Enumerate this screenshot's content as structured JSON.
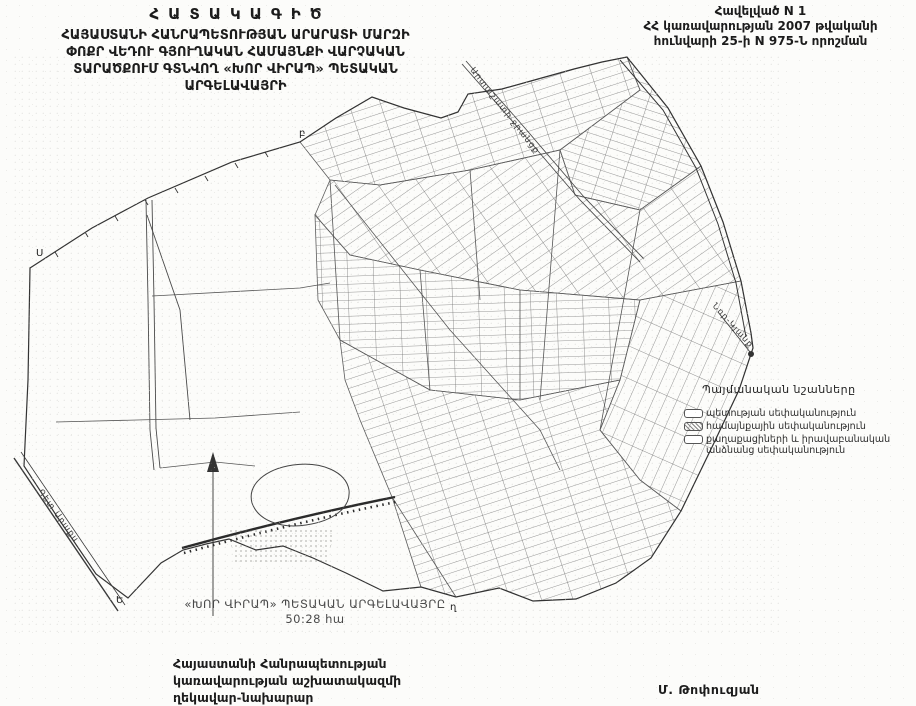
{
  "header": {
    "title": "ՀԱՏԱԿԱԳԻԾ",
    "subtitle_lines": [
      "ՀԱՅԱՍՏԱՆԻ ՀԱՆՐԱՊԵՏՈՒԹՅԱՆ ԱՐԱՐԱՏԻ ՄԱՐԶԻ",
      "ՓՈՔՐ ՎԵԴՈՒ ԳՅՈՒՂԱԿԱՆ ՀԱՄԱՅՆՔԻ ՎԱՐՉԱԿԱՆ",
      "ՏԱՐԱԾՔՈՒՄ ԳՏՆՎՈՂ «ԽՈՐ ՎԻՐԱՊ» ՊԵՏԱԿԱՆ",
      "ԱՐԳԵԼԱՎԱՅՐԻ"
    ],
    "annex_lines": [
      "Հավելված N 1",
      "ՀՀ կառավարության 2007 թվականի",
      "հունվարի 25-ի N 975-Ն որոշման"
    ]
  },
  "legend": {
    "title": "Պայմանական նշանները",
    "items": [
      {
        "label": "պետության սեփականություն",
        "swatch": "outline"
      },
      {
        "label": "համայնքային սեփականություն",
        "swatch": "hatched"
      },
      {
        "label": "քաղաքացիների և իրավաբանական անձնանց սեփականություն",
        "swatch": "outline"
      }
    ]
  },
  "map": {
    "labels": {
      "river": "Գետ Արաքս",
      "canal": "Արտաշատի ջրանցք",
      "destination": "Նոր-Կյանք"
    },
    "boundary_letters": [
      "Ս",
      "բ",
      "Ե",
      "ղ"
    ],
    "area_title": "«ԽՈՐ ՎԻՐԱՊ» ՊԵՏԱԿԱՆ ԱՐԳԵԼԱՎԱՅՐԸ",
    "area_value": "50:28 հա"
  },
  "footer": {
    "signatory_lines": [
      "Հայաստանի Հանրապետության",
      "կառավարության աշխատակազմի",
      "ղեկավար-նախարար"
    ],
    "signature": "Մ. Թոփուզյան"
  }
}
